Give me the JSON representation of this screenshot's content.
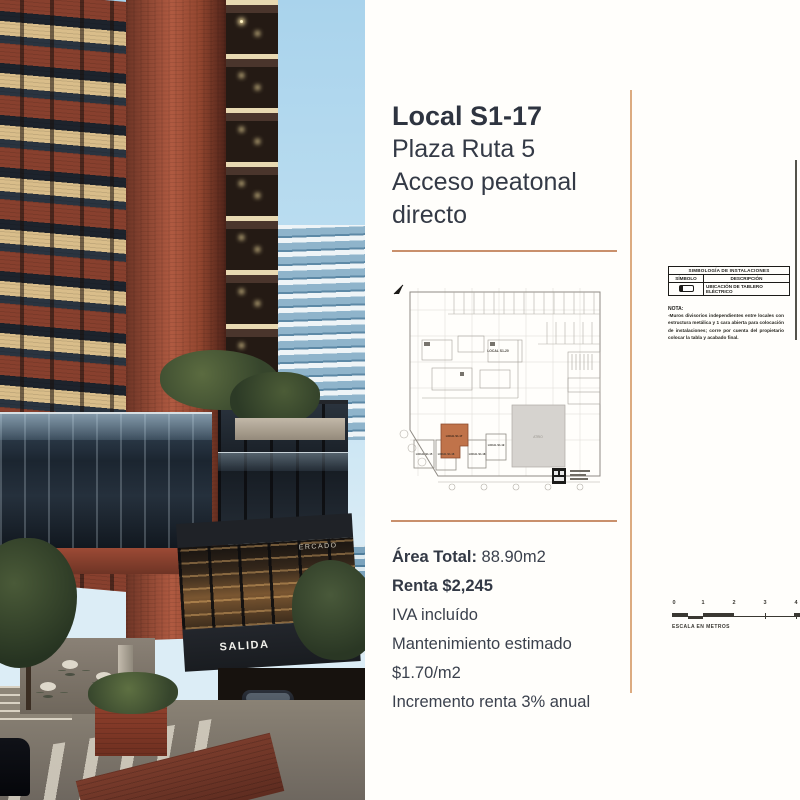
{
  "header": {
    "title": "Local S1-17",
    "line1": "Plaza Ruta 5",
    "line2": "Acceso peatonal directo"
  },
  "details": {
    "area_label": "Área Total:",
    "area_value": " 88.90m2",
    "renta": "Renta $2,245",
    "iva": "IVA incluído",
    "mantenimiento": "Mantenimiento estimado $1.70/m2",
    "incremento": "Incremento renta 3% anual"
  },
  "floorplan": {
    "unit_labels": {
      "s115": "LOCAL S1-15",
      "s116": "LOCAL S1-16",
      "s117": "LOCAL S1-17",
      "s118": "LOCAL S1-18",
      "s119": "LOCAL S1-19",
      "s120": "LOCAL S1-20"
    },
    "atrium_label": "ATRIO",
    "highlight_color": "#c0734a"
  },
  "legend": {
    "title": "SIMBOLOGÍA DE INSTALACIONES",
    "col_symbol": "SÍMBOLO",
    "col_desc": "DESCRIPCIÓN",
    "row1_desc": "UBICACIÓN DE TABLERO ELÉCTRICO",
    "nota_label": "NOTA:",
    "nota_text": "-Muros divisorios independientes entre locales con estructura metálica y 1 cara abierta para colocación de instalaciones; corre por cuenta del propietario colocar la tabla y acabado final."
  },
  "scalebar": {
    "ticks": [
      "0",
      "1",
      "2",
      "3",
      "4"
    ],
    "label": "ESCALA EN METROS"
  },
  "photo": {
    "sign_salida": "SALIDA",
    "sign_entrada_partial": "EN",
    "store_sign_partial": "ERCADO"
  },
  "colors": {
    "accent_tan": "#dcab80",
    "accent_line": "#c9906c",
    "text_dark": "#343a46",
    "highlight_orange": "#c0734a",
    "brick": "#9e4f38",
    "sky": "#b9ddf0"
  }
}
